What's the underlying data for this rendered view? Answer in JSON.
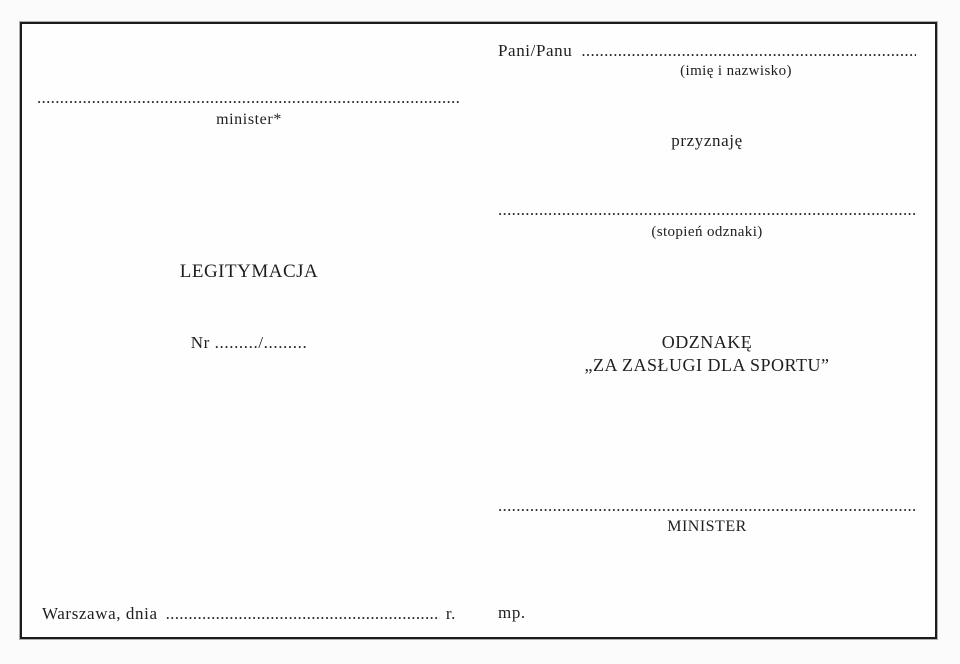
{
  "colors": {
    "ink": "#1f1f1f",
    "border": "#1b1b1b",
    "paper": "#fefefe"
  },
  "left": {
    "minister_line_dots": "........................................................................................................................................",
    "minister_label": "minister*",
    "title": "LEGITYMACJA",
    "number_line": "Nr ........./.........",
    "date_prefix": "Warszawa, dnia",
    "date_dots": "........................................................................................................................................",
    "date_suffix": "r."
  },
  "right": {
    "recipient_prefix": "Pani/Panu",
    "recipient_dots": "........................................................................................................................................",
    "recipient_caption": "(imię i nazwisko)",
    "grant_verb": "przyznaję",
    "degree_dots": "........................................................................................................................................",
    "degree_caption": "(stopień odznaki)",
    "badge_line1": "ODZNAKĘ",
    "badge_line2": "„ZA ZASŁUGI DLA SPORTU”",
    "signature_dots": "........................................................................................................................................",
    "signature_caption": "MINISTER",
    "seal_abbr": "mp."
  }
}
